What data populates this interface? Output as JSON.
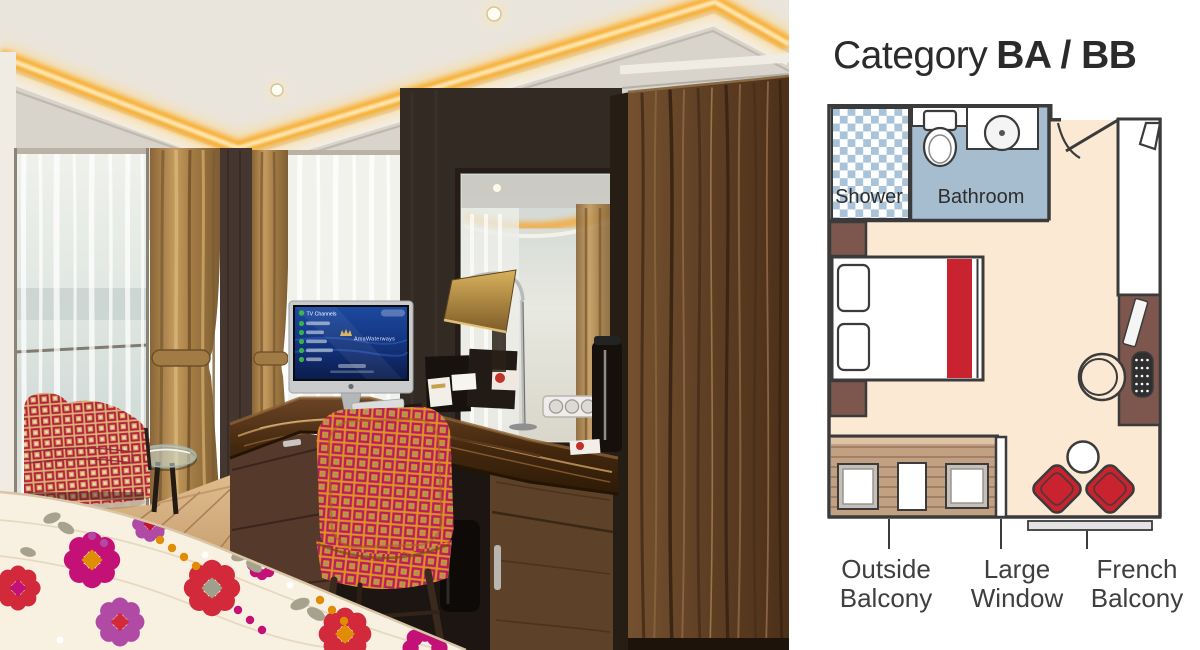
{
  "page": {
    "background": "#ffffff",
    "description": "Cruise ship stateroom photo beside Category BA/BB deck plan"
  },
  "photo": {
    "name": "stateroom-photo",
    "imac_screen": {
      "header": "TV Channels",
      "logo": "AmaWaterways"
    }
  },
  "floorplan": {
    "title": {
      "prefix": "Category",
      "bold": "BA / BB"
    },
    "rooms": {
      "shower": "Shower",
      "bathroom": "Bathroom"
    },
    "callouts": [
      {
        "id": "outside-balcony",
        "line1": "Outside",
        "line2": "Balcony"
      },
      {
        "id": "large-window",
        "line1": "Large",
        "line2": "Window"
      },
      {
        "id": "french-balcony",
        "line1": "French",
        "line2": "Balcony"
      }
    ],
    "features": [
      "shower",
      "toilet",
      "sink",
      "entry-door",
      "closet",
      "double-bed",
      "pillows",
      "nightstands",
      "vanity-desk",
      "stool",
      "telephone",
      "deck-chairs",
      "deck-table",
      "french-balcony-chairs",
      "french-balcony-table",
      "railing",
      "large-window"
    ],
    "colors": {
      "floor": "#fbe9d4",
      "bathroom": "#a6bccf",
      "checker_blue": "#a9c3d9",
      "wall": "#3b3b3b",
      "accent_red": "#c8232e",
      "furniture_brown": "#7d574d",
      "deck_tan": "#c2a082",
      "railing_gray": "#e3e3e3",
      "label_text": "#3f3f3f",
      "title_text": "#2b2b2b"
    }
  }
}
